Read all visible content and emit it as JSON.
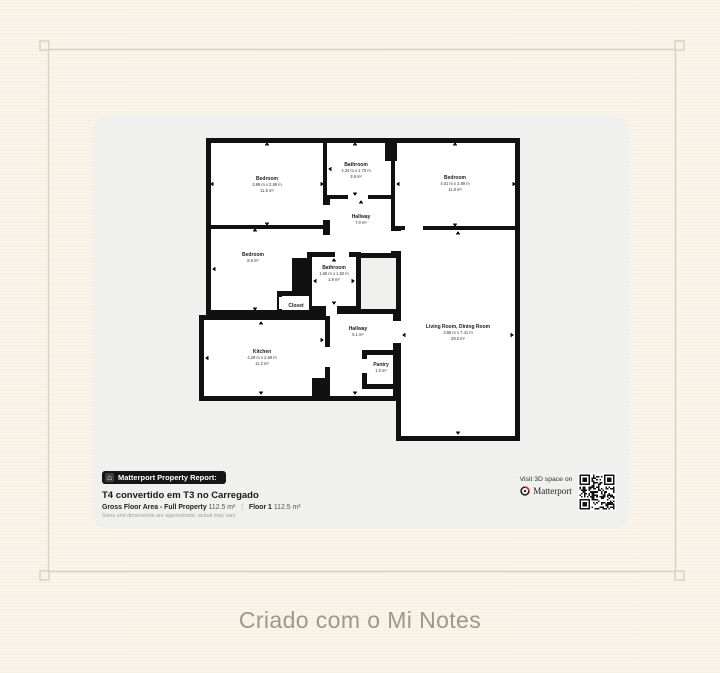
{
  "page": {
    "watermark": "Criado com o Mi Notes"
  },
  "report": {
    "badge": "Matterport Property Report:",
    "title": "T4 convertido em T3 no Carregado",
    "gross_label": "Gross Floor Area - Full Property",
    "gross_value": "112.5 m²",
    "separator": "|",
    "floor_label": "Floor 1",
    "floor_value": "112.5 m²",
    "disclaimer": "Sizes and dimensions are approximate, actual may vary",
    "visit": "Visit 3D space on",
    "brand": "Matterport"
  },
  "floorplan": {
    "rooms": {
      "bedroom_tl": {
        "name": "Bedroom",
        "dims": "3.99 m x 2.86 m",
        "area": "11.5 m²"
      },
      "bathroom_top": {
        "name": "Bathroom",
        "dims": "2.34 m x 1.75 m",
        "area": "3.9 m²"
      },
      "bedroom_tr": {
        "name": "Bedroom",
        "dims": "4.01 m x 2.89 m",
        "area": "11.8 m²"
      },
      "hallway_top": {
        "name": "Hallway",
        "area": "7.0 m²"
      },
      "bedroom_ml": {
        "name": "Bedroom",
        "area": "8.8 m²"
      },
      "bathroom_mid": {
        "name": "Bathroom",
        "dims": "1.66 m x 1.82 m",
        "area": "2.9 m²"
      },
      "closet": {
        "name": "Closet"
      },
      "kitchen": {
        "name": "Kitchen",
        "dims": "4.29 m x 2.69 m",
        "area": "11.2 m²"
      },
      "hallway_bot": {
        "name": "Hallway",
        "area": "5.1 m²"
      },
      "pantry": {
        "name": "Pantry",
        "area": "1.0 m²"
      },
      "living": {
        "name": "Living Room, Dining Room",
        "dims": "3.96 m x 7.41 m",
        "area": "29.3 m²"
      }
    }
  },
  "colors": {
    "page_bg": "#faf5ea",
    "card_bg": "#f0f0ee",
    "wall": "#111111",
    "frame_line": "#d4d0c2",
    "watermark_text": "#9c9889",
    "badge_bg": "#161616",
    "matterport_red": "#e2231a"
  }
}
